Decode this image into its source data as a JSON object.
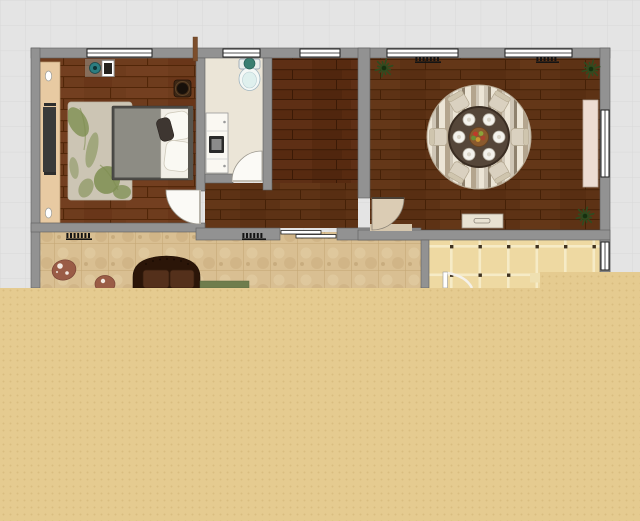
{
  "app": {
    "type": "floor-plan-editor",
    "view": "2d-plan-canvas"
  },
  "canvas": {
    "width": 640,
    "height": 521
  },
  "grid": {
    "cell": 25.3,
    "bg": "#e4e4e4",
    "line": "#d8d8d8"
  },
  "colors": {
    "wall": "#929292",
    "wall_edge": "#5e5e5e",
    "bedroom_floor": "#6e3c1d",
    "bedroom_floor_line": "#512608",
    "middle_floor": "#572a10",
    "middle_floor_line": "#3b1a06",
    "dining_floor": "#5d3215",
    "dining_floor_line": "#452107",
    "bath_floor": "#ebe5d7",
    "living_tile": "#d9bf92",
    "living_tile_line": "#c5a775",
    "kitchen_tile": "#eed9a2",
    "kitchen_grout": "#f6ebc6",
    "kitchen_dot": "#3f3220",
    "overlay": "#e5cb90",
    "overlay_dot": "#d9bd80",
    "window_fill": "#ffffff",
    "window_stroke": "#1e1e1e",
    "door_fill": "#fbfaf6",
    "door_tan": "#dbccb4",
    "rug_bedroom": "#ccc5b4",
    "rug_leaf": "#7e8e51",
    "bed_frame": "#4c4b47",
    "bed_mattress": "#8d8c84",
    "bed_linen": "#f2efe7",
    "wardrobe": "#e8caa2",
    "tv_panel": "#3a3a3a",
    "sofa": "#2b1508",
    "sofa_cushion": "#54301b",
    "mat_green": "#6f7d4d",
    "rug_red": "#9a5c46",
    "table": "#554639",
    "chair": "#dad1c0",
    "chair_back": "#cfc5ae",
    "plate": "#f4f2ec",
    "rug_stripe_a": "#cfc6b6",
    "rug_stripe_b": "#b4a58e",
    "rug_stripe_c": "#ece5d6",
    "rug_stripe_d": "#8f826e",
    "centerpiece": "#8a5a2e",
    "plant": "#2e4c20",
    "sideboard": "#eddcd2",
    "console": "#e9e2d2",
    "radiator": "#141414",
    "toilet_lid": "#3a7f71",
    "stub": "#7c4e2c"
  },
  "rooms": [
    {
      "id": "bedroom",
      "furniture": [
        "wardrobe",
        "tv-panel",
        "double-bed",
        "area-rug",
        "desk-decor",
        "plant-pot",
        "wall-sconces"
      ]
    },
    {
      "id": "bathroom",
      "furniture": [
        "toilet",
        "vanity-with-washer"
      ]
    },
    {
      "id": "second-room",
      "furniture": []
    },
    {
      "id": "dining-room",
      "furniture": [
        "round-dining-table",
        "six-chairs",
        "round-rug",
        "console-table",
        "sideboard",
        "three-potted-plants"
      ]
    },
    {
      "id": "living-room",
      "furniture": [
        "leather-sofa",
        "oval-rug",
        "round-rug",
        "green-floor-mat"
      ]
    },
    {
      "id": "kitchen",
      "furniture": []
    }
  ],
  "walls": [
    {
      "x": 31,
      "y": 48,
      "w": 579,
      "h": 10,
      "n": "wall-top"
    },
    {
      "x": 31,
      "y": 48,
      "w": 9,
      "h": 240,
      "n": "wall-left"
    },
    {
      "x": 600,
      "y": 48,
      "w": 10,
      "h": 224,
      "n": "wall-right"
    },
    {
      "x": 196,
      "y": 58,
      "w": 9,
      "h": 133,
      "n": "wall-bedroom-hall"
    },
    {
      "x": 196,
      "y": 224,
      "w": 9,
      "h": 8,
      "n": "wall-bedroom-hall-stub"
    },
    {
      "x": 263,
      "y": 58,
      "w": 9,
      "h": 132,
      "n": "wall-bath-right"
    },
    {
      "x": 205,
      "y": 174,
      "w": 28,
      "h": 9,
      "n": "wall-bath-bottom"
    },
    {
      "x": 358,
      "y": 48,
      "w": 12,
      "h": 150,
      "n": "wall-dining-left"
    },
    {
      "x": 358,
      "y": 228,
      "w": 12,
      "h": 12,
      "n": "wall-dining-left-stub"
    },
    {
      "x": 31,
      "y": 223,
      "w": 174,
      "h": 9,
      "n": "wall-bedroom-bottom"
    },
    {
      "x": 196,
      "y": 228,
      "w": 84,
      "h": 12,
      "n": "wall-corridor-bottom-left"
    },
    {
      "x": 337,
      "y": 228,
      "w": 84,
      "h": 12,
      "n": "wall-corridor-bottom-right"
    },
    {
      "x": 358,
      "y": 230,
      "w": 252,
      "h": 10,
      "n": "wall-dining-bottom"
    },
    {
      "x": 421,
      "y": 240,
      "w": 8,
      "h": 48,
      "n": "wall-kitchen-left"
    },
    {
      "x": 600,
      "y": 240,
      "w": 10,
      "h": 32,
      "n": "wall-right-lower"
    }
  ],
  "windows": [
    {
      "x": 87,
      "y": 49,
      "w": 65,
      "h": 8,
      "dir": "h",
      "n": "bedroom-window"
    },
    {
      "x": 223,
      "y": 49,
      "w": 37,
      "h": 8,
      "dir": "h",
      "n": "bathroom-window"
    },
    {
      "x": 300,
      "y": 49,
      "w": 40,
      "h": 8,
      "dir": "h",
      "n": "second-room-window"
    },
    {
      "x": 387,
      "y": 49,
      "w": 71,
      "h": 8,
      "dir": "h",
      "n": "dining-window-left"
    },
    {
      "x": 505,
      "y": 49,
      "w": 67,
      "h": 8,
      "dir": "h",
      "n": "dining-window-right"
    },
    {
      "x": 601,
      "y": 110,
      "w": 8,
      "h": 67,
      "dir": "v",
      "n": "dining-side-window"
    },
    {
      "x": 601,
      "y": 242,
      "w": 8,
      "h": 28,
      "dir": "v",
      "n": "kitchen-window"
    }
  ],
  "radiators": [
    {
      "x": 66,
      "y": 233,
      "w": 26,
      "h": 7
    },
    {
      "x": 242,
      "y": 233,
      "w": 24,
      "h": 7
    },
    {
      "x": 415,
      "y": 57,
      "w": 26,
      "h": 6
    },
    {
      "x": 536,
      "y": 57,
      "w": 23,
      "h": 6
    }
  ],
  "plants": [
    {
      "cx": 384,
      "cy": 68,
      "r": 9
    },
    {
      "cx": 591,
      "cy": 69,
      "r": 9
    },
    {
      "cx": 585,
      "cy": 216,
      "r": 9
    }
  ],
  "dining_set": {
    "cx": 479,
    "cy": 137,
    "rug_r": 52,
    "table_r": 30,
    "chair_dist": 40,
    "plate_dist": 20,
    "plate_r": 6,
    "angles": [
      0,
      60,
      120,
      180,
      240,
      300
    ],
    "fruits": [
      [
        -3.5,
        -3,
        "#bf3a2a"
      ],
      [
        2,
        -3.5,
        "#8aa33a"
      ],
      [
        -1,
        2.5,
        "#c8952f"
      ],
      [
        4,
        1,
        "#a8432f"
      ],
      [
        -5.5,
        1,
        "#6a8f33"
      ]
    ]
  },
  "overlay": {
    "path": "M0,288 L540,288 L540,272 L640,272 L640,521 L0,521 Z"
  }
}
